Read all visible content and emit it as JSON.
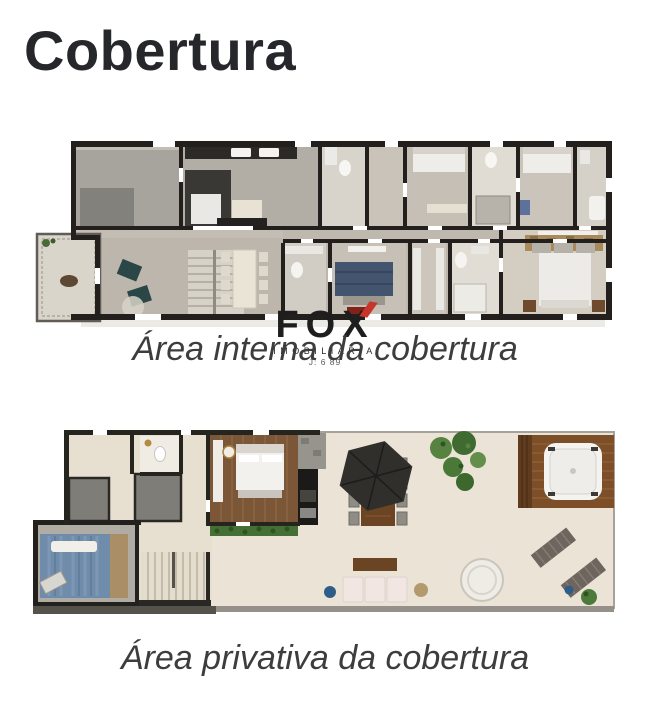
{
  "page": {
    "title": "Cobertura",
    "background": "#ffffff"
  },
  "watermark": {
    "brand": "FOX",
    "subtitle": "IMOBILIÁRIA",
    "registration": "J: 6 89",
    "accent_color": "#c9342a"
  },
  "plans": [
    {
      "caption": "Área interna da cobertura"
    },
    {
      "caption": "Área privativa da cobertura"
    }
  ],
  "palette": {
    "wall": "#23211e",
    "floor_warm_gray": "#c3bdb4",
    "floor_travertine": "#e7dfd0",
    "terrace_cream": "#ebe4d6",
    "wood_floor": "#7b5737",
    "wood_deck": "#7c4f28",
    "pool_blue": "#6f8cab",
    "bed_blue": "#43546f",
    "teal_chair": "#2b4646",
    "hedge_green": "#456f35",
    "plant_green": "#4a7837",
    "tv_red": "#83221a"
  }
}
